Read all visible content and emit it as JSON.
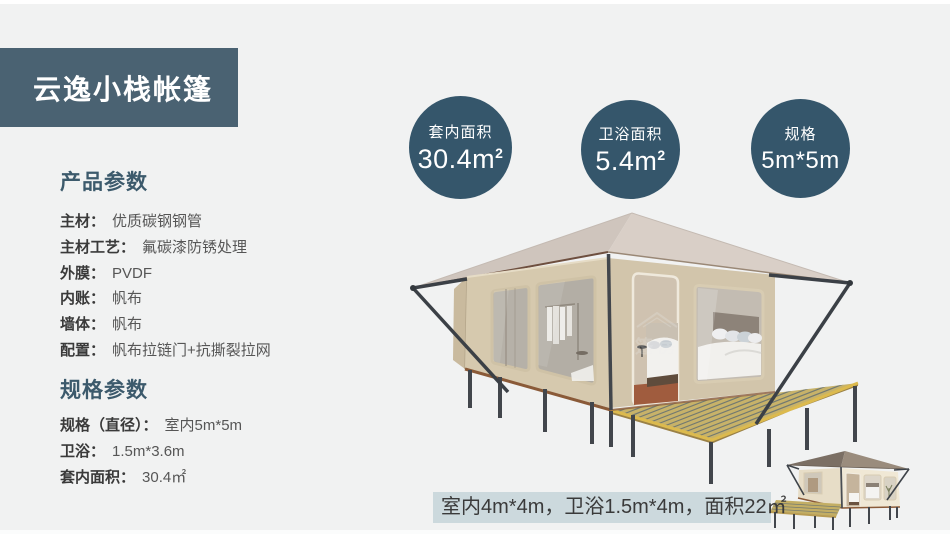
{
  "page": {
    "background": "#f1f2f2",
    "accent": "#35566b",
    "banner_color": "#4a6272",
    "caption_bg": "#ccd9dd"
  },
  "header": {
    "title": "云逸小栈帐篷"
  },
  "stats": [
    {
      "label": "套内面积",
      "value": "30.4m",
      "sup": "2"
    },
    {
      "label": "卫浴面积",
      "value": "5.4m",
      "sup": "2"
    },
    {
      "label": "规格",
      "value": "5m*5m",
      "sup": ""
    }
  ],
  "product_params": {
    "title": "产品参数",
    "items": [
      {
        "label": "主材：",
        "value": "优质碳钢钢管"
      },
      {
        "label": "主材工艺：",
        "value": "氟碳漆防锈处理"
      },
      {
        "label": "外膜：",
        "value": "PVDF"
      },
      {
        "label": "内账：",
        "value": "帆布"
      },
      {
        "label": "墙体：",
        "value": "帆布"
      },
      {
        "label": "配置：",
        "value": "帆布拉链门+抗撕裂拉网"
      }
    ]
  },
  "spec_params": {
    "title": "规格参数",
    "items": [
      {
        "label": "规格（直径）：",
        "value": "室内5m*5m"
      },
      {
        "label": "卫浴：",
        "value": "1.5m*3.6m"
      },
      {
        "label": "套内面积：",
        "value": "30.4㎡"
      }
    ]
  },
  "caption": {
    "text": "室内4m*4m，卫浴1.5m*4m，面积22㎡"
  }
}
